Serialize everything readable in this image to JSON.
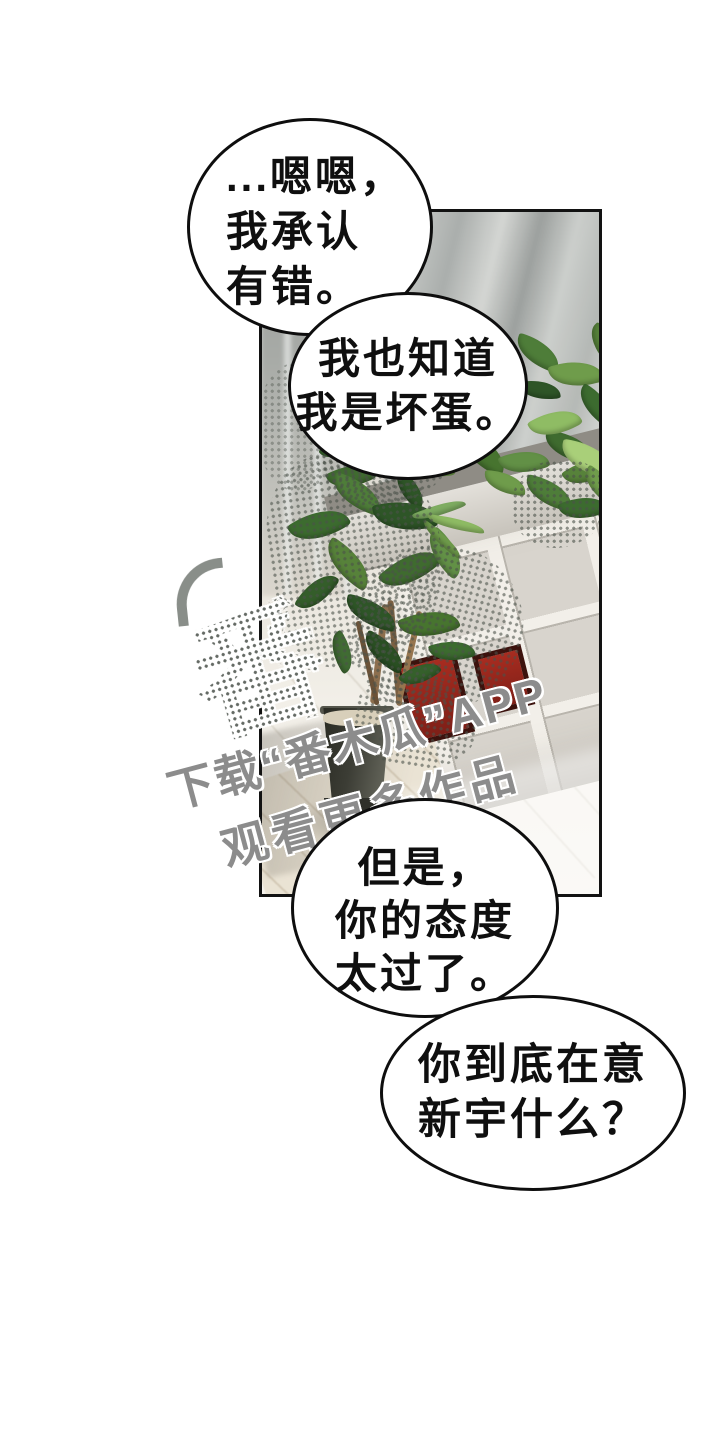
{
  "bubbles": [
    {
      "name": "bubble-1",
      "lines": [
        "...嗯嗯，",
        "我承认",
        "有错。"
      ]
    },
    {
      "name": "bubble-2",
      "lines": [
        "我也知道",
        "我是坏蛋。"
      ]
    },
    {
      "name": "bubble-3",
      "lines": [
        "但是，",
        "你的态度",
        "太过了。"
      ]
    },
    {
      "name": "bubble-4",
      "lines": [
        "你到底在意",
        "新宇什么？"
      ]
    }
  ],
  "watermark": {
    "download_line": "下载“番木瓜”APP",
    "watch_line": "观看更多作品",
    "logo_glyph": "番"
  },
  "colors": {
    "ink": "#111111",
    "bubble_fill": "#ffffff",
    "watermark_gray": "#8c8c8c",
    "leaf_green_dark": "#2e5527",
    "leaf_green_light": "#8fbc64",
    "pot_dark": "#35362e",
    "book_red": "#9e2b20",
    "floor_warm": "#efece4"
  }
}
